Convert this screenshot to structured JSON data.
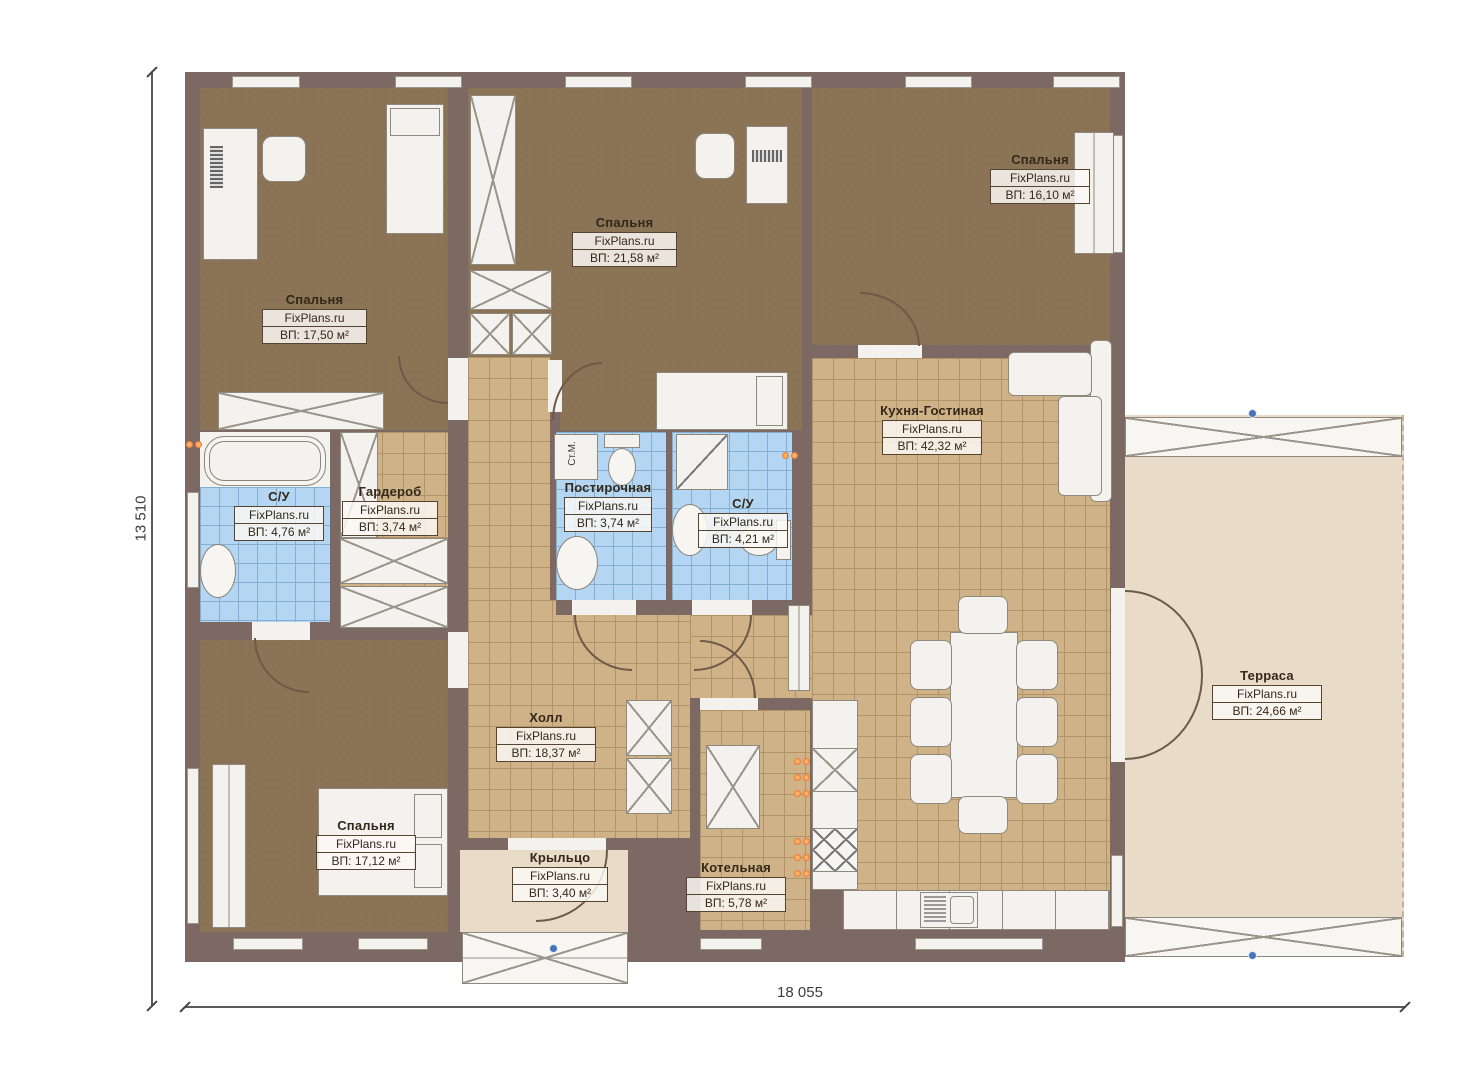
{
  "dimensions": {
    "width_label": "18 055",
    "height_label": "13 510"
  },
  "labels": {
    "washing_machine": "Ст.М."
  },
  "rooms": [
    {
      "id": "bedroom-top-left",
      "name": "Спальня",
      "watermark": "FixPlans.ru",
      "area": "ВП: 17,50 м²"
    },
    {
      "id": "bedroom-top-mid",
      "name": "Спальня",
      "watermark": "FixPlans.ru",
      "area": "ВП: 21,58 м²"
    },
    {
      "id": "bedroom-top-right",
      "name": "Спальня",
      "watermark": "FixPlans.ru",
      "area": "ВП: 16,10 м²"
    },
    {
      "id": "kitchen-living",
      "name": "Кухня-Гостиная",
      "watermark": "FixPlans.ru",
      "area": "ВП: 42,32 м²"
    },
    {
      "id": "bathroom-left",
      "name": "С/У",
      "watermark": "FixPlans.ru",
      "area": "ВП: 4,76 м²"
    },
    {
      "id": "wardrobe",
      "name": "Гардероб",
      "watermark": "FixPlans.ru",
      "area": "ВП: 3,74 м²"
    },
    {
      "id": "laundry",
      "name": "Постирочная",
      "watermark": "FixPlans.ru",
      "area": "ВП: 3,74 м²"
    },
    {
      "id": "bathroom-mid",
      "name": "С/У",
      "watermark": "FixPlans.ru",
      "area": "ВП: 4,21 м²"
    },
    {
      "id": "hall",
      "name": "Холл",
      "watermark": "FixPlans.ru",
      "area": "ВП: 18,37 м²"
    },
    {
      "id": "bedroom-bottom-left",
      "name": "Спальня",
      "watermark": "FixPlans.ru",
      "area": "ВП: 17,12 м²"
    },
    {
      "id": "porch",
      "name": "Крыльцо",
      "watermark": "FixPlans.ru",
      "area": "ВП: 3,40 м²"
    },
    {
      "id": "boiler-room",
      "name": "Котельная",
      "watermark": "FixPlans.ru",
      "area": "ВП: 5,78 м²"
    },
    {
      "id": "terrace",
      "name": "Терраса",
      "watermark": "FixPlans.ru",
      "area": "ВП: 24,66 м²"
    }
  ],
  "colors": {
    "wall": "#7d6964",
    "bedroom_floor": "#8b7356",
    "tile_floor": "#cfb287",
    "bathroom_floor": "#b4d6f2",
    "terrace_floor": "#e8dcc8",
    "marker_orange": "#e8742c",
    "marker_blue": "#4a72b8"
  }
}
